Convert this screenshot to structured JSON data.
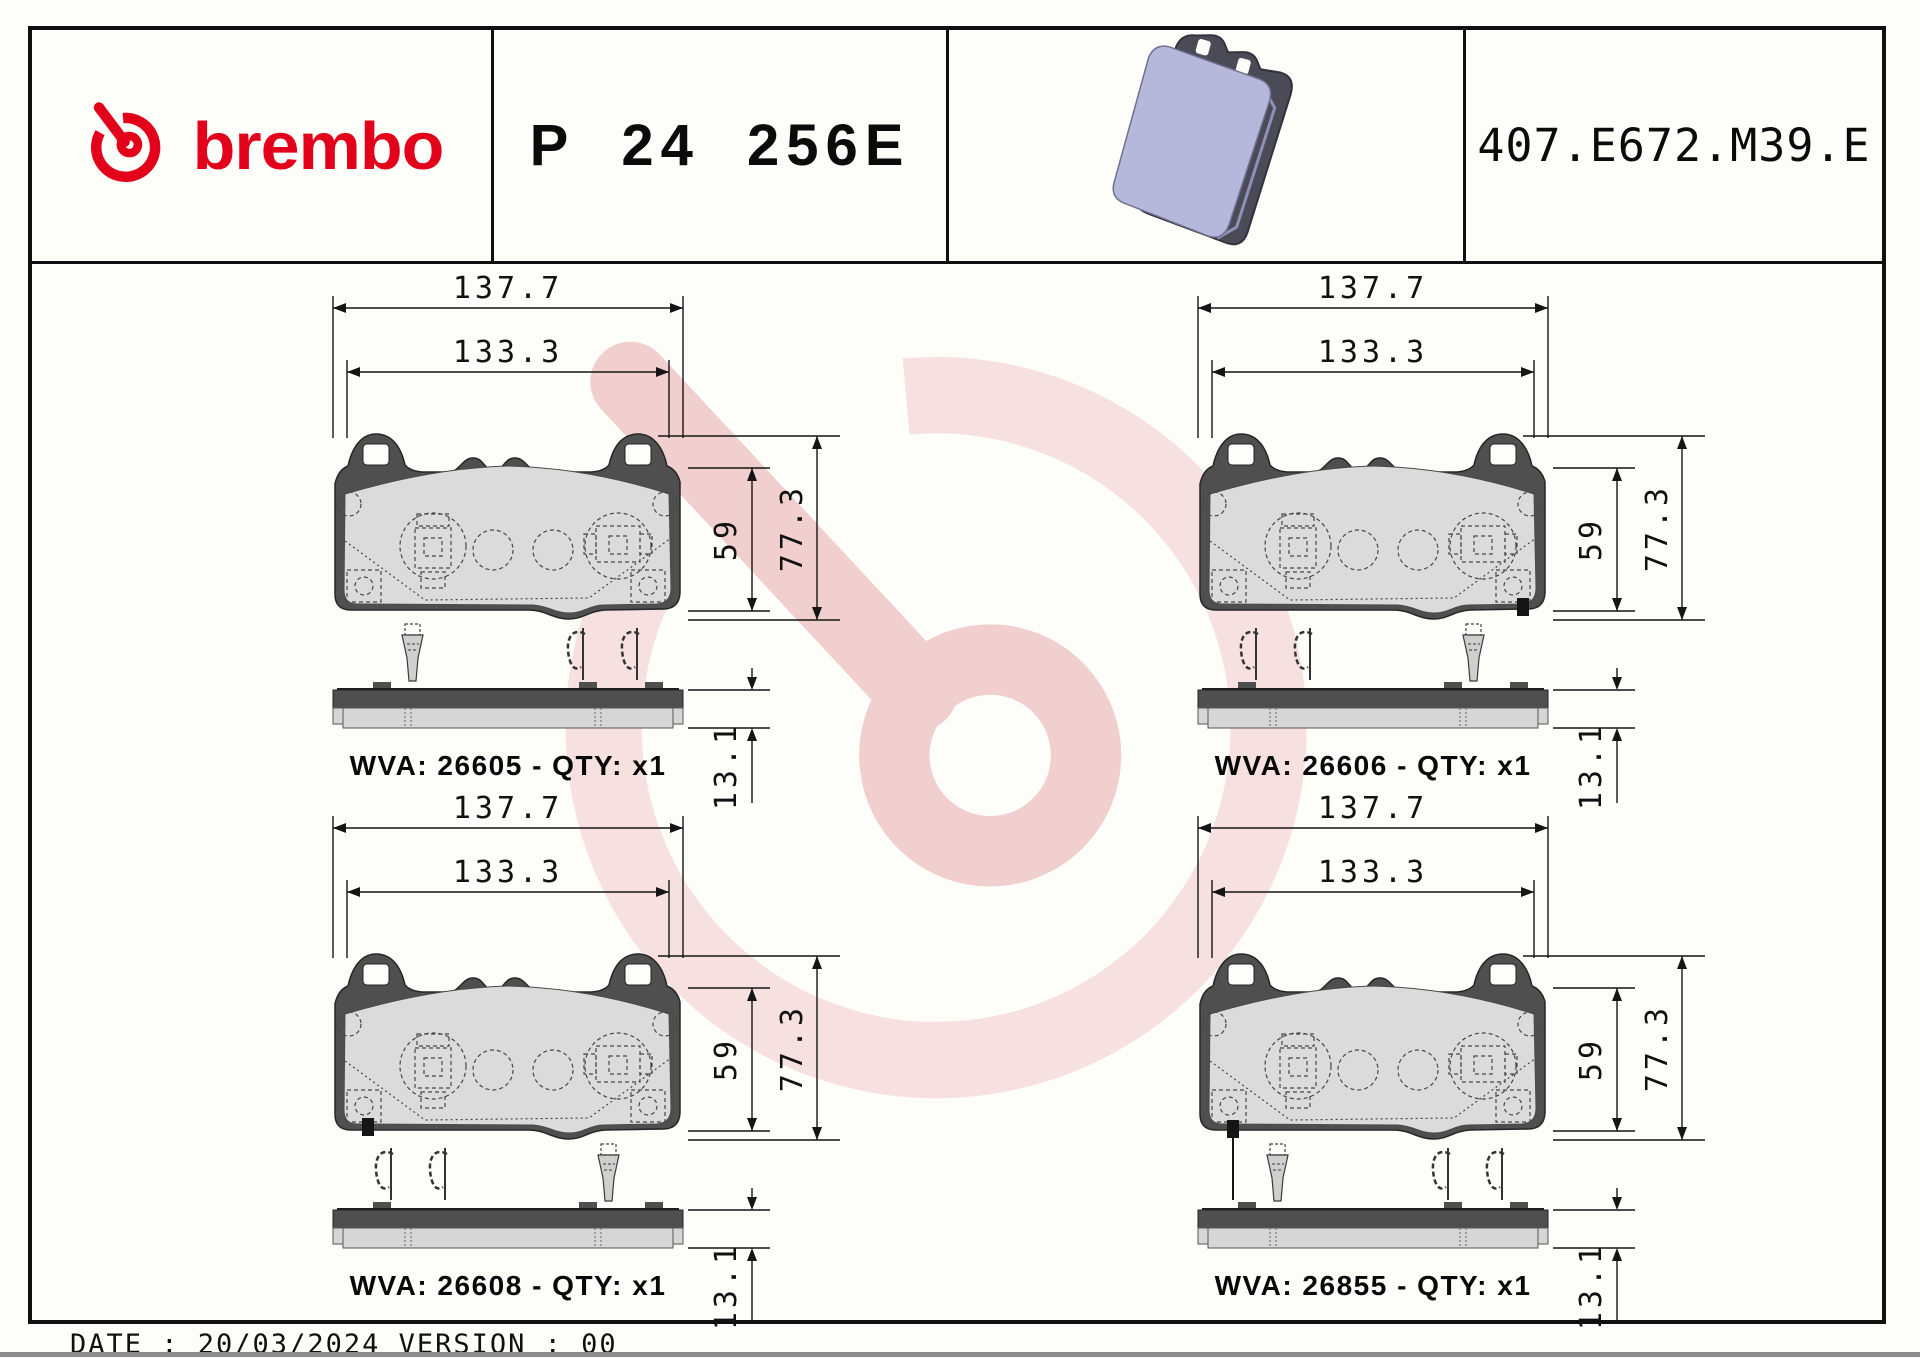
{
  "header": {
    "brand_wordmark": "brembo",
    "part_number": "P 24 256E",
    "catalog_reference": "407.E672.M39.E",
    "icons": {
      "brand_icon": "brembo-b-ring",
      "product_image": "brake-pad-3d-render"
    }
  },
  "dimensions": {
    "overall_width": "137.7",
    "pad_width": "133.3",
    "pad_height": "59",
    "overall_height": "77.3",
    "thickness": "13.1"
  },
  "quadrants": [
    {
      "position": "top-left",
      "wva": "26605",
      "qty": "x1",
      "label": "WVA: 26605 - QTY: x1"
    },
    {
      "position": "top-right",
      "wva": "26606",
      "qty": "x1",
      "label": "WVA: 26606 - QTY: x1"
    },
    {
      "position": "bottom-left",
      "wva": "26608",
      "qty": "x1",
      "label": "WVA: 26608 - QTY: x1"
    },
    {
      "position": "bottom-right",
      "wva": "26855",
      "qty": "x1",
      "label": "WVA: 26855 - QTY: x1"
    }
  ],
  "footer": {
    "text": "DATE : 20/03/2024 VERSION : 00"
  },
  "colors": {
    "brand_red": "#e2001a",
    "backplate_gray": "#4f4f4f",
    "friction_gray": "#dbdbdb",
    "render_friction": "#b6b8db",
    "render_backplate": "#4b4b58",
    "watermark_light": "#f7e0e0",
    "watermark_mid": "#f2cfcf"
  }
}
